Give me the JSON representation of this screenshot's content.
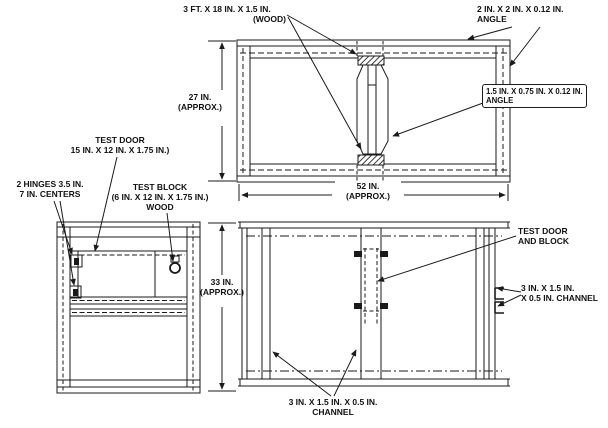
{
  "figure": {
    "type": "engineering-drawing",
    "background_color": "#ffffff",
    "line_color": "#1a1a1a",
    "views": [
      "front elevation (top)",
      "side view (bottom left)",
      "frame elevation (bottom right)"
    ],
    "labels": {
      "wood": {
        "line1": "3 FT. X 18 IN. X 1.5 IN.",
        "line2": "(WOOD)"
      },
      "angle_2in": {
        "line1": "2 IN. X 2 IN. X 0.12 IN.",
        "line2": "ANGLE"
      },
      "angle_1_5in": {
        "line1": "1.5 IN. X 0.75 IN. X 0.12 IN.",
        "line2": "ANGLE"
      },
      "dim_27": {
        "line1": "27 IN.",
        "line2": "(APPROX.)"
      },
      "dim_52": {
        "line1": "52 IN.",
        "line2": "(APPROX.)"
      },
      "dim_33": {
        "line1": "33 IN.",
        "line2": "(APPROX.)"
      },
      "test_door": {
        "line1": "TEST DOOR",
        "line2": "15 IN. X 12 IN. X 1.75 IN.)"
      },
      "hinges": {
        "line1": "2 HINGES 3.5 IN.",
        "line2": "7 IN. CENTERS"
      },
      "test_block": {
        "line1": "TEST BLOCK",
        "line2": "(6 IN. X 12 IN. X 1.75 IN.)",
        "line3": "WOOD"
      },
      "door_and_block": {
        "line1": "TEST DOOR",
        "line2": "AND BLOCK"
      },
      "channel_right": {
        "line1": "3 IN. X 1.5 IN.",
        "line2": "X 0.5 IN. CHANNEL"
      },
      "channel_bottom": {
        "line1": "3 IN. X 1.5 IN. X 0.5 IN.",
        "line2": "CHANNEL"
      }
    }
  }
}
